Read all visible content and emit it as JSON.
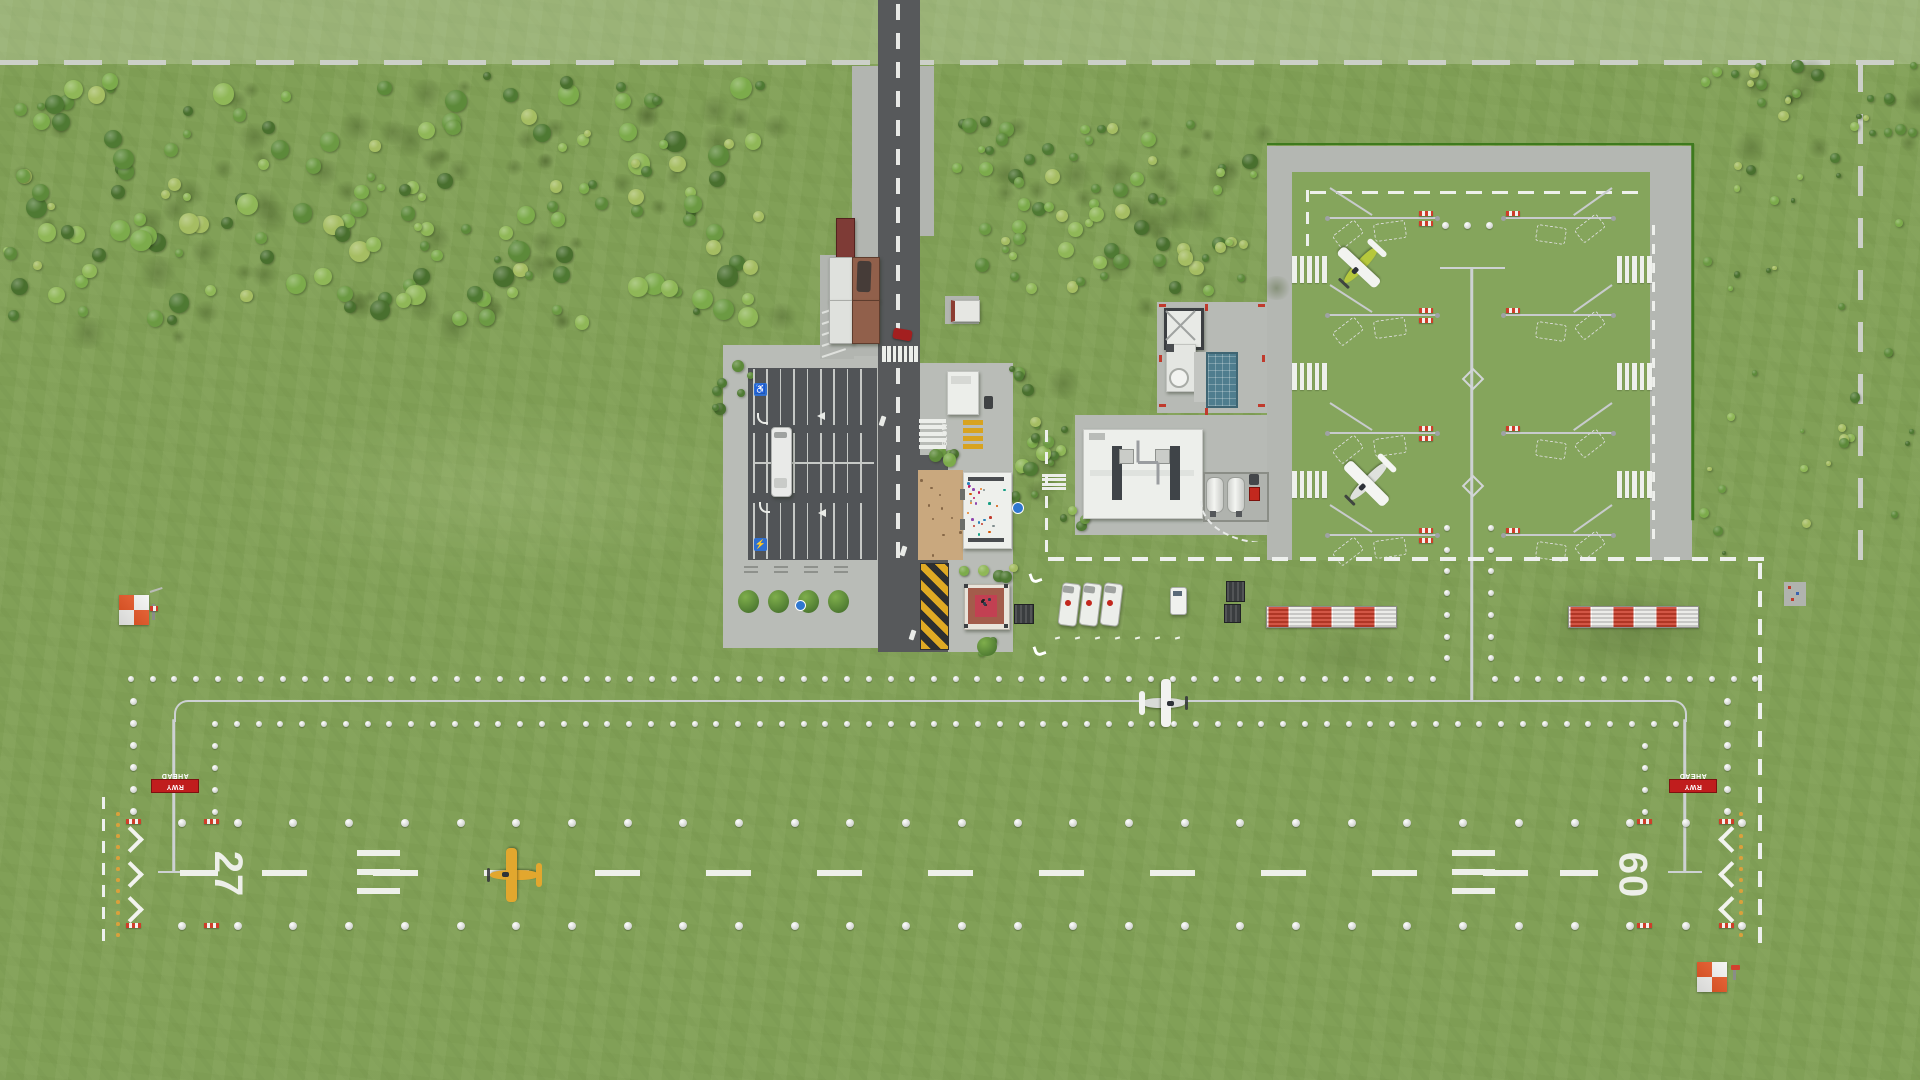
{
  "meta": {
    "app": "airport-builder-game",
    "view": "top-down-airfield-overview"
  },
  "runway": {
    "west_number": "27",
    "east_number": "09",
    "surface": "grass",
    "marking_color": "#edefe9"
  },
  "signs": {
    "rwy_ahead_left": "RWY AHEAD",
    "rwy_ahead_right": "RWY AHEAD",
    "road_slow": "SLOW"
  },
  "colors": {
    "grass": "#81a057",
    "asphalt_road": "#57595b",
    "parking_asphalt": "#515457",
    "concrete_plaza": "#b9bcb7",
    "apron_concrete": "#b4b7b2",
    "marking_white": "#f2f3f0",
    "taxi_line": "#cdd1d3",
    "checker_red": "#e8521f",
    "barrier_red": "#cc3f2b",
    "chevron_yellow": "#d8a31f",
    "accent_blue": "#2f77d0",
    "fence_green": "#3e7a1e",
    "courtyard_tan": "#c9a87e",
    "plaza_red": "#c24052"
  },
  "aircraft": [
    {
      "id": "yellow-taildragger",
      "location": "runway",
      "heading": "west",
      "color": "#e2a72e"
    },
    {
      "id": "white-taxiing-plane",
      "location": "taxiway",
      "heading": "east",
      "color": "#eceeea"
    },
    {
      "id": "green-white-plane",
      "location": "apron-tiedown-north",
      "heading": "southwest",
      "color": "#b6c83c"
    },
    {
      "id": "white-apron-plane",
      "location": "apron-tiedown-south",
      "heading": "southwest",
      "color": "#eceeea"
    }
  ],
  "vehicles": [
    {
      "id": "fuel-truck-1"
    },
    {
      "id": "fuel-truck-2"
    },
    {
      "id": "fuel-truck-3"
    },
    {
      "id": "white-pickup"
    },
    {
      "id": "red-car-road"
    },
    {
      "id": "dark-van-shelter"
    },
    {
      "id": "white-bus-parking"
    },
    {
      "id": "dark-car-security"
    }
  ],
  "buildings": [
    {
      "id": "terminal-building"
    },
    {
      "id": "security-office"
    },
    {
      "id": "main-hangar"
    },
    {
      "id": "control-tower"
    },
    {
      "id": "fuel-farm"
    },
    {
      "id": "red-courtyard-pavilion"
    },
    {
      "id": "parking-shelters"
    },
    {
      "id": "bus-stop-shelter"
    }
  ]
}
